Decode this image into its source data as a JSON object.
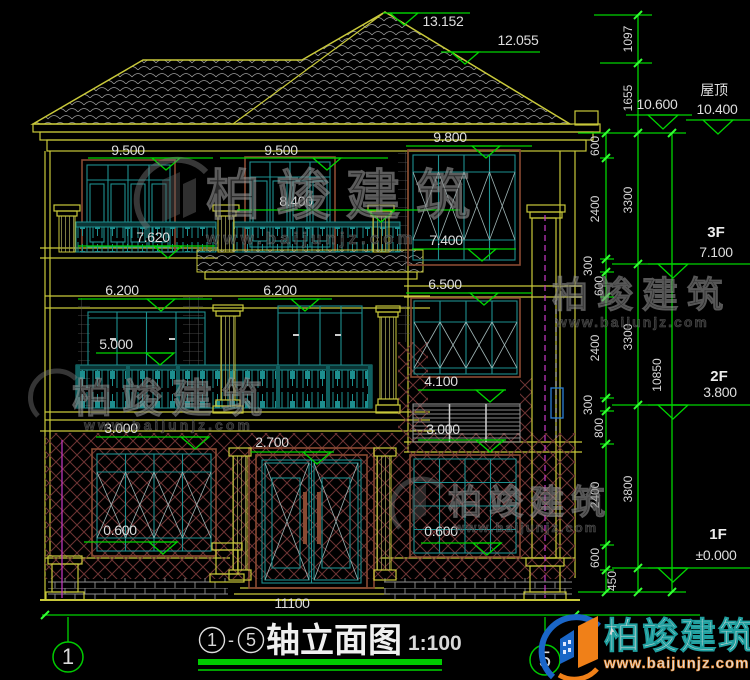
{
  "marks": {
    "peak": "13.152",
    "upper": "12.055",
    "l950": "9.500",
    "m950": "9.500",
    "m840": "8.400",
    "r980": "9.800",
    "l762": "7.620",
    "r740": "7.400",
    "r650": "6.500",
    "l620": "6.200",
    "m620": "6.200",
    "l500": "5.000",
    "r410": "4.100",
    "l300": "3.000",
    "r300": "3.000",
    "d270": "2.700",
    "l060": "0.600",
    "r060": "0.600"
  },
  "right_panel": {
    "eave": "10.600",
    "roof_label": "屋顶",
    "roof_elev": "10.400",
    "f3_label": "3F",
    "f3_elev": "7.100",
    "f2_label": "2F",
    "f2_elev": "3.800",
    "f1_label": "1F",
    "f1_elev": "±0.000",
    "chain_a": [
      "600",
      "2400",
      "300",
      "600",
      "2400",
      "300",
      "800",
      "2400",
      "600",
      "450"
    ],
    "chain_b": [
      "1097",
      "1655",
      "3300",
      "3300",
      "3800"
    ],
    "total": "10850"
  },
  "bottom": {
    "width_total": "11100"
  },
  "axes": {
    "left": "1",
    "right": "5"
  },
  "title_block": {
    "axis_start": "1",
    "dash": "-",
    "axis_end": "5",
    "title": "轴立面图",
    "scale": "1:100"
  },
  "watermark": {
    "brand": "柏竣建筑",
    "url": "www.baijunjz.com",
    "accent_blue": "#1a66c8",
    "accent_orange": "#f08018"
  }
}
